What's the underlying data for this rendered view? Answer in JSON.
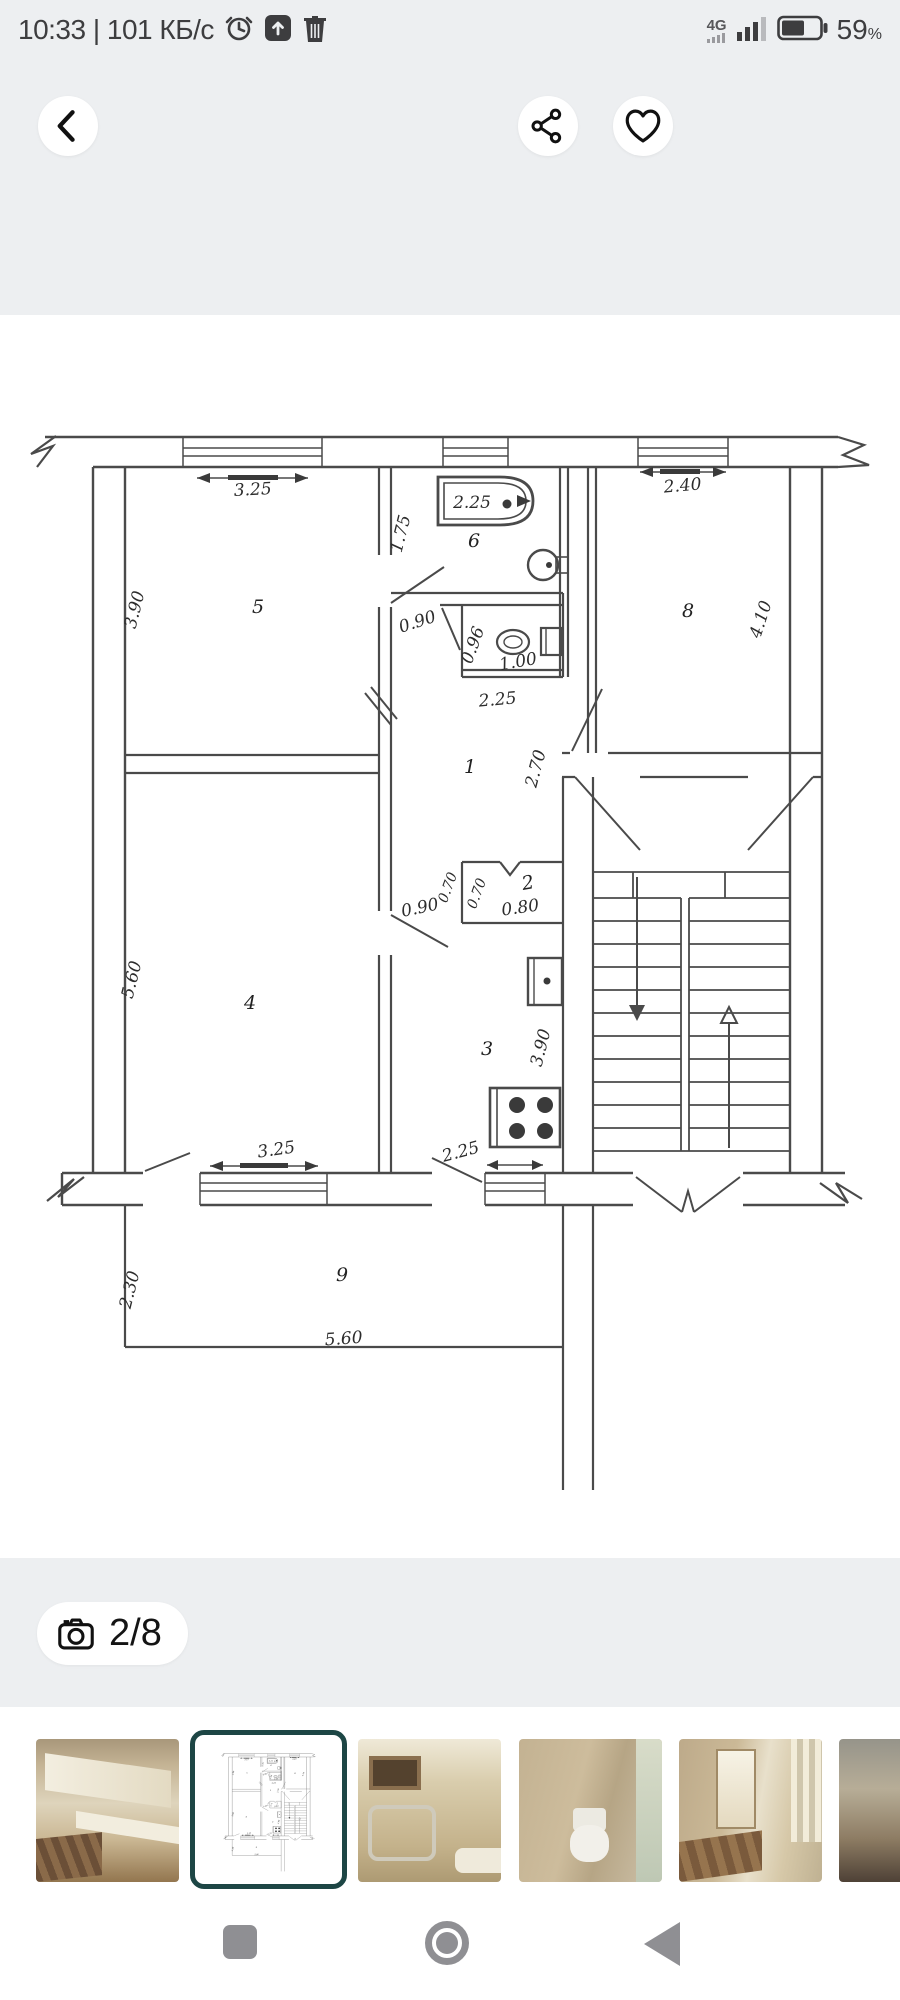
{
  "status_bar": {
    "left_text": "10:33 | 101 КБ/с",
    "network": "4G",
    "battery_text": "59",
    "percent": "%"
  },
  "photo_counter": "2/8",
  "plan": {
    "rooms": {
      "hall": "1",
      "closet": "2",
      "kitchen": "3",
      "room4": "4",
      "room5": "5",
      "bathroom": "6",
      "room8": "8",
      "balcony": "9"
    },
    "dims": {
      "room5_w": "3.25",
      "room5_h": "3.90",
      "tub": "2.25",
      "bath_h": "1.75",
      "door_up": "0.90",
      "wc_a": "0.96",
      "wc_b": "1.00",
      "wc_w": "2.25",
      "hall_h": "2.70",
      "room8_w": "2.40",
      "room8_h": "4.10",
      "room4_h": "5.60",
      "closet_a": "0.70",
      "closet_b": "0.70",
      "closet_w": "0.80",
      "door_low": "0.90",
      "kitchen_h": "3.90",
      "kitchen_win": "2.25",
      "room4_win": "3.25",
      "balcony_h": "2.30",
      "balcony_w": "5.60"
    }
  },
  "colors": {
    "top_bg": "#edeff1",
    "selected_thumb_border": "#1d4645",
    "nav_icon": "#8f8f93"
  }
}
